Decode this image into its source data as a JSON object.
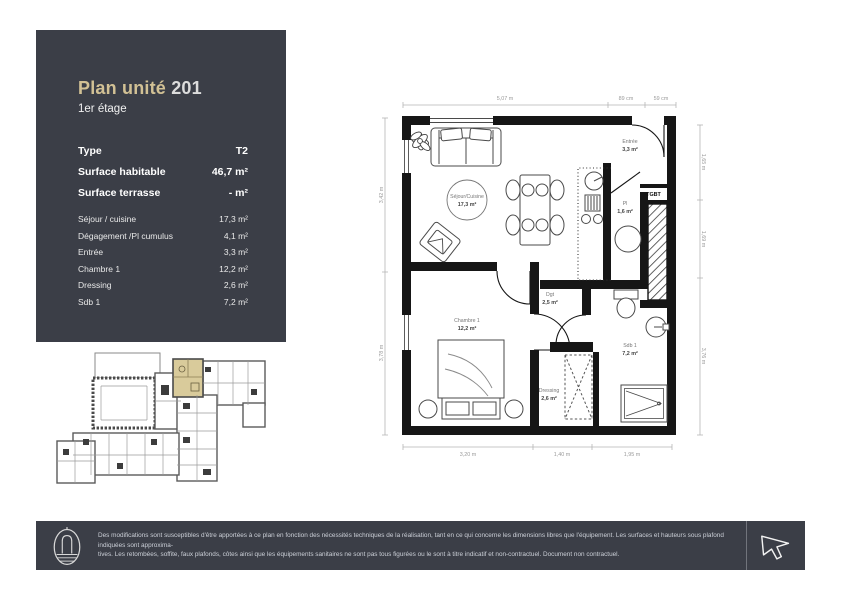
{
  "panel": {
    "title_main": "Plan unité",
    "title_number": "201",
    "subtitle": "1er étage",
    "summary": [
      {
        "label": "Type",
        "value": "T2"
      },
      {
        "label": "Surface habitable",
        "value": "46,7 m²"
      },
      {
        "label": "Surface terrasse",
        "value": "- m²"
      }
    ],
    "rooms": [
      {
        "label": "Séjour / cuisine",
        "value": "17,3 m²"
      },
      {
        "label": "Dégagement /Pl cumulus",
        "value": "4,1 m²"
      },
      {
        "label": "Entrée",
        "value": "3,3 m²"
      },
      {
        "label": "Chambre 1",
        "value": "12,2 m²"
      },
      {
        "label": "Dressing",
        "value": "2,6 m²"
      },
      {
        "label": "Sdb 1",
        "value": "7,2 m²"
      }
    ]
  },
  "plan": {
    "rooms": {
      "sejour": {
        "name": "Séjour/Cuisine",
        "area": "17,3 m²"
      },
      "entree": {
        "name": "Entrée",
        "area": "3,3 m²"
      },
      "pl": {
        "name": "Pl",
        "area": "1,6 m²"
      },
      "dgt": {
        "name": "Dgt",
        "area": "2,5 m²"
      },
      "chambre": {
        "name": "Chambre 1",
        "area": "12,2 m²"
      },
      "dressing": {
        "name": "Dressing",
        "area": "2,6 m²"
      },
      "sdb": {
        "name": "Sdb 1",
        "area": "7,2 m²"
      }
    },
    "tgbt": "TGBT",
    "dimensions": {
      "top": [
        "5,07 m",
        "89 cm",
        "59 cm"
      ],
      "bottom": [
        "3,20 m",
        "1,40 m",
        "1,95 m"
      ],
      "left": [
        "3,42 m",
        "3,78 m"
      ],
      "right": [
        "1,65 m",
        "1,69 m",
        "3,76 m"
      ]
    }
  },
  "footer": {
    "disclaimer_line1": "Des modifications sont susceptibles d'être apportées à ce plan en fonction des nécessités techniques de la réalisation, tant en ce qui concerne les dimensions libres que l'équipement. Les surfaces et hauteurs sous plafond indiquées sont approxima-",
    "disclaimer_line2": "tives. Les retombées, soffite, faux plafonds, côtes ainsi que les équipements sanitaires ne sont pas tous figurées ou le sont à titre indicatif et non-contractuel. Document non contractuel."
  },
  "colors": {
    "panel_bg": "#3b3e47",
    "accent_beige": "#d2c195",
    "highlight_unit": "#d9cb9b",
    "wall_black": "#161616"
  }
}
